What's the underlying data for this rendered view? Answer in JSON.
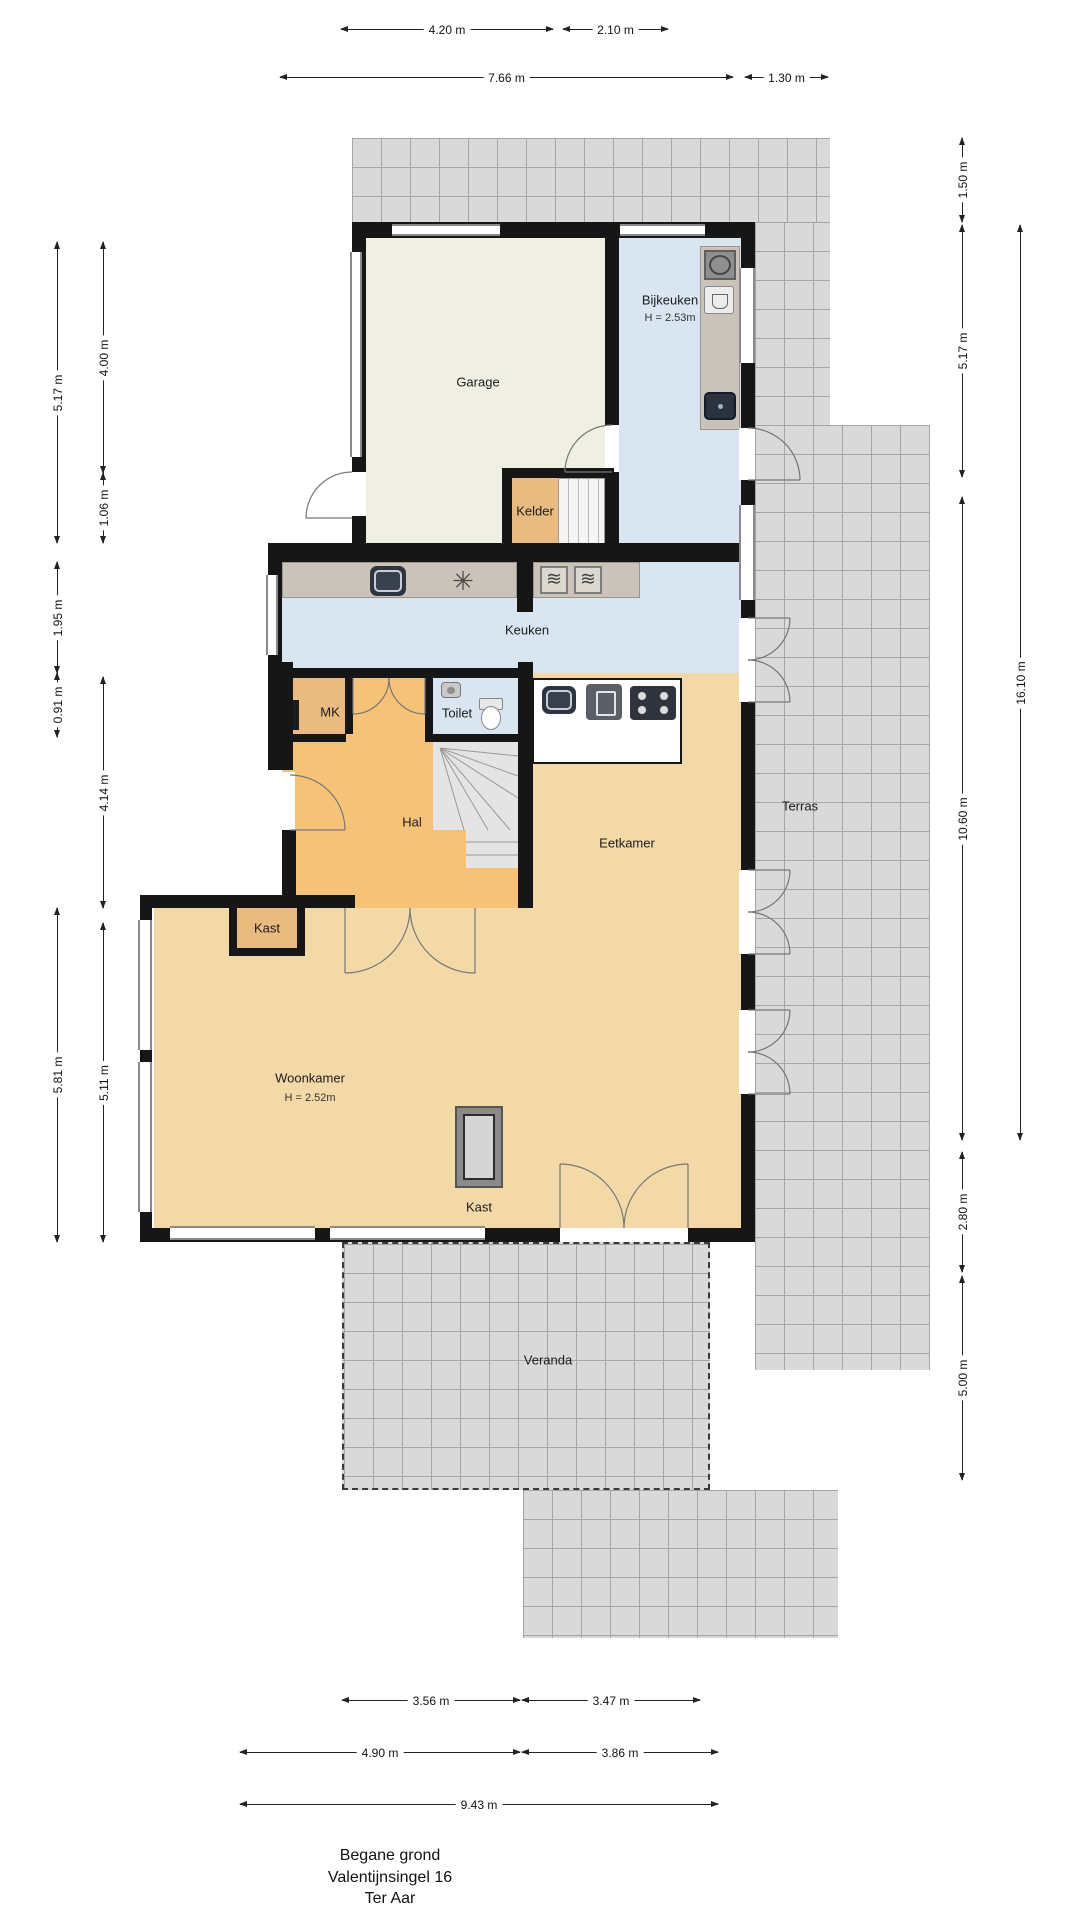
{
  "plan": {
    "rooms": {
      "garage": "Garage",
      "bijkeuken": "Bijkeuken",
      "bijkeuken_h": "H = 2.53m",
      "kelder": "Kelder",
      "keuken": "Keuken",
      "mk": "MK",
      "toilet": "Toilet",
      "hal": "Hal",
      "eetkamer": "Eetkamer",
      "kast_hal": "Kast",
      "woonkamer": "Woonkamer",
      "woonkamer_h": "H = 2.52m",
      "kast_woonkamer": "Kast",
      "terras": "Terras",
      "veranda": "Veranda"
    },
    "dimensions": {
      "top": [
        "4.20 m",
        "2.10 m",
        "7.66 m",
        "1.30 m"
      ],
      "left": [
        "5.17 m",
        "1.95 m",
        "0.91 m",
        "5.81 m",
        "4.00 m",
        "1.06 m",
        "4.14 m",
        "5.11 m"
      ],
      "right": [
        "1.50 m",
        "5.17 m",
        "10.60 m",
        "2.80 m",
        "5.00 m",
        "16.10 m"
      ],
      "bottom": [
        "3.56 m",
        "3.47 m",
        "4.90 m",
        "3.86 m",
        "9.43 m"
      ]
    },
    "title": [
      "Begane grond",
      "Valentijnsingel 16",
      "Ter Aar"
    ],
    "palette": {
      "wall": "#161616",
      "garage_fill": "#f0efe4",
      "wet_room_fill": "#d9e6f2",
      "hall_fill": "#f6c278",
      "closet_fill": "#e9bb80",
      "living_fill": "#f3d9a8",
      "terrace_fill": "#d9d9d9",
      "counter": "#c9c3b9"
    }
  }
}
